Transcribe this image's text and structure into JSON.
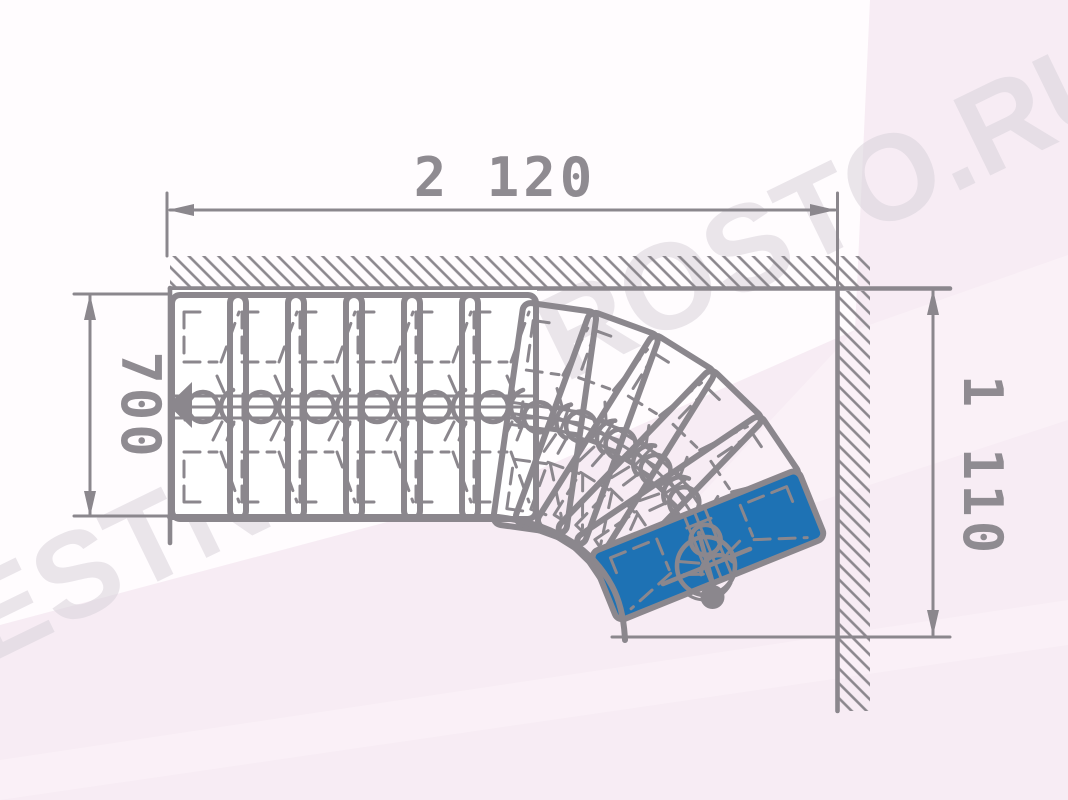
{
  "drawing": {
    "type": "staircase-plan-top-view",
    "description": "Plan drawing of an L-shaped modular staircase with winder treads turning at walls"
  },
  "watermark": {
    "text": "LESTNICY-PROSTO.RU"
  },
  "dimensions": {
    "top": {
      "label": "2 120"
    },
    "left": {
      "label": "700"
    },
    "right": {
      "label": "1 110"
    }
  },
  "colors": {
    "line": "#8b878d",
    "dim_text": "#8f8b91",
    "tread_highlight": "#1e72b4",
    "watermark": "#d9d3db",
    "background": "#f7ecf4",
    "paper_white": "#fffdfe"
  },
  "stair": {
    "straight_tread_count": 6,
    "winder_tread_count": 6,
    "highlighted_tread": "last winder (blue)",
    "geometry": {
      "tread_depth": 74,
      "tread_length": 224,
      "corner_radius": 8
    },
    "treads": [
      {
        "cx": 209.0,
        "cy": 407.0,
        "rot": 0,
        "highlight": false
      },
      {
        "cx": 267.0,
        "cy": 407.0,
        "rot": 0,
        "highlight": false
      },
      {
        "cx": 325.0,
        "cy": 407.0,
        "rot": 0,
        "highlight": false
      },
      {
        "cx": 383.0,
        "cy": 407.0,
        "rot": 0,
        "highlight": false
      },
      {
        "cx": 441.0,
        "cy": 407.0,
        "rot": 0,
        "highlight": false
      },
      {
        "cx": 499.0,
        "cy": 407.0,
        "rot": 0,
        "highlight": false
      },
      {
        "cx": 544.8,
        "cy": 418.1,
        "rot": 8,
        "highlight": false
      },
      {
        "cx": 586.8,
        "cy": 428.5,
        "rot": 20,
        "highlight": false
      },
      {
        "cx": 625.7,
        "cy": 447.5,
        "rot": 32,
        "highlight": false
      },
      {
        "cx": 659.8,
        "cy": 474.1,
        "rot": 44,
        "highlight": false
      },
      {
        "cx": 687.6,
        "cy": 507.2,
        "rot": 56,
        "highlight": false
      },
      {
        "cx": 707.9,
        "cy": 545.4,
        "rot": 68,
        "highlight": true
      }
    ]
  }
}
